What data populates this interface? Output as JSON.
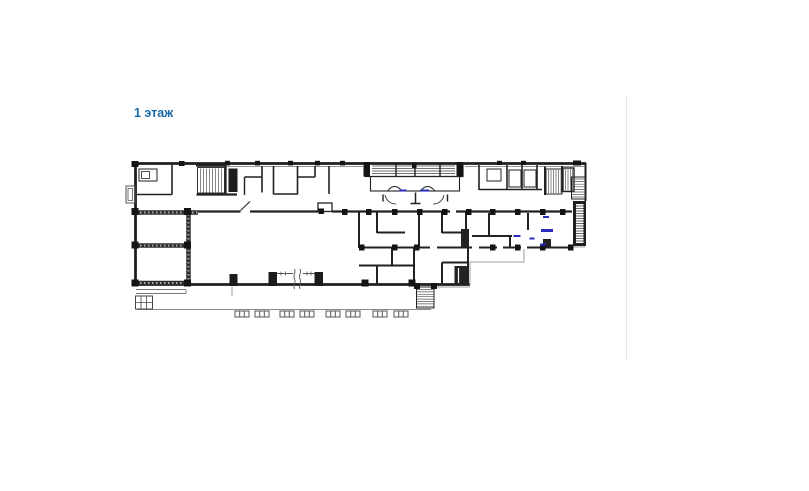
{
  "page": {
    "background_color": "#ffffff"
  },
  "content": {
    "floor_label": "1 этаж",
    "floor_label_color": "#1568a9"
  },
  "floor_plan": {
    "colors": {
      "walls": "#1f1f1f",
      "hatch": "#8f8f8f",
      "light_outline": "#9e9e9e",
      "door_marks_blue": "#2b2bc0"
    }
  },
  "layout_divider": {
    "color": "#e5e5e5"
  }
}
